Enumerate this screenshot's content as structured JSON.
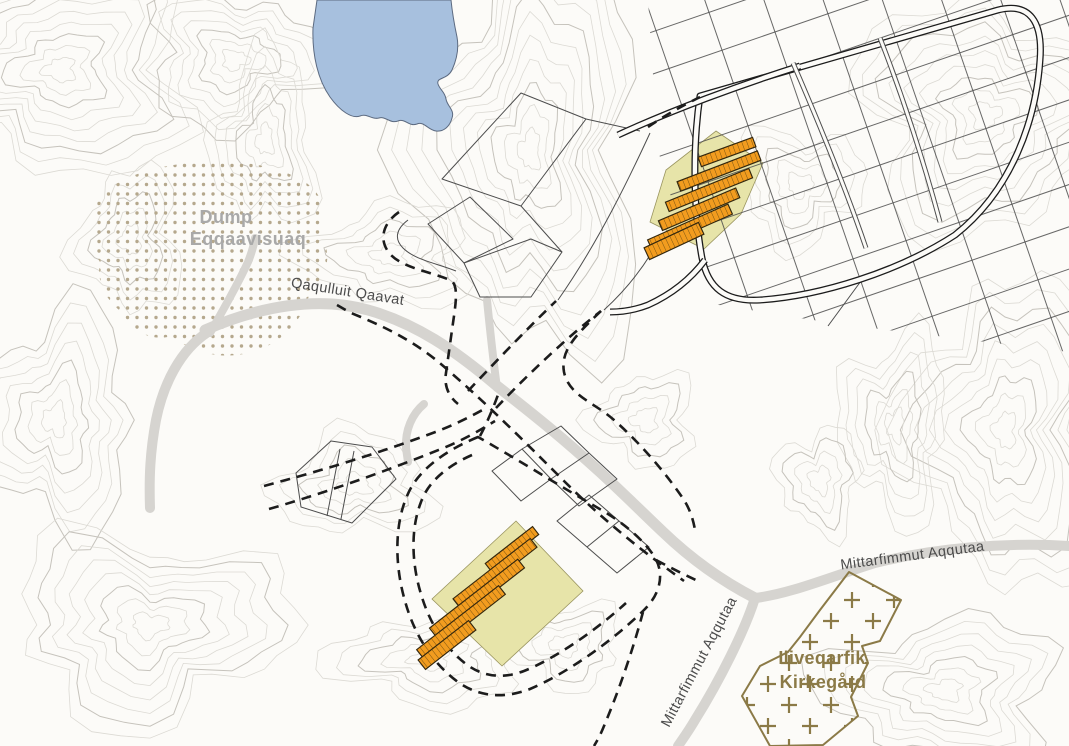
{
  "map": {
    "labels": {
      "dump_line1": "Dump",
      "dump_line2": "Eqqaavisuaq",
      "road_qaqulluit": "Qaqulluit Qaavat",
      "road_mittarfimmut_east": "Mittarfimmut Aqqutaa",
      "road_mittarfimmut_south": "Mittarfimmut Aqqutaa",
      "cemetery_line1": "Iliveqarfik",
      "cemetery_line2": "Kirkegård"
    },
    "colors": {
      "background": "#fcfbf8",
      "contour": "#dcdad4",
      "contour_bold": "#c6c3bc",
      "water": "#a7c0de",
      "water_edge": "#5c6a80",
      "road_fill": "#d6d4d0",
      "planned_road": "#1c1c1c",
      "parcel_line": "#4d4d4d",
      "plot_fill": "#e7e4a9",
      "plot_edge": "#99945f",
      "building_fill": "#f29c1f",
      "building_line": "#7a5310",
      "building_outline": "#33270e",
      "dump_dot": "#b5a88d",
      "dump_label": "#a9a9a9",
      "road_label": "#4c4c4c",
      "cemetery": "#8b7a47"
    }
  }
}
